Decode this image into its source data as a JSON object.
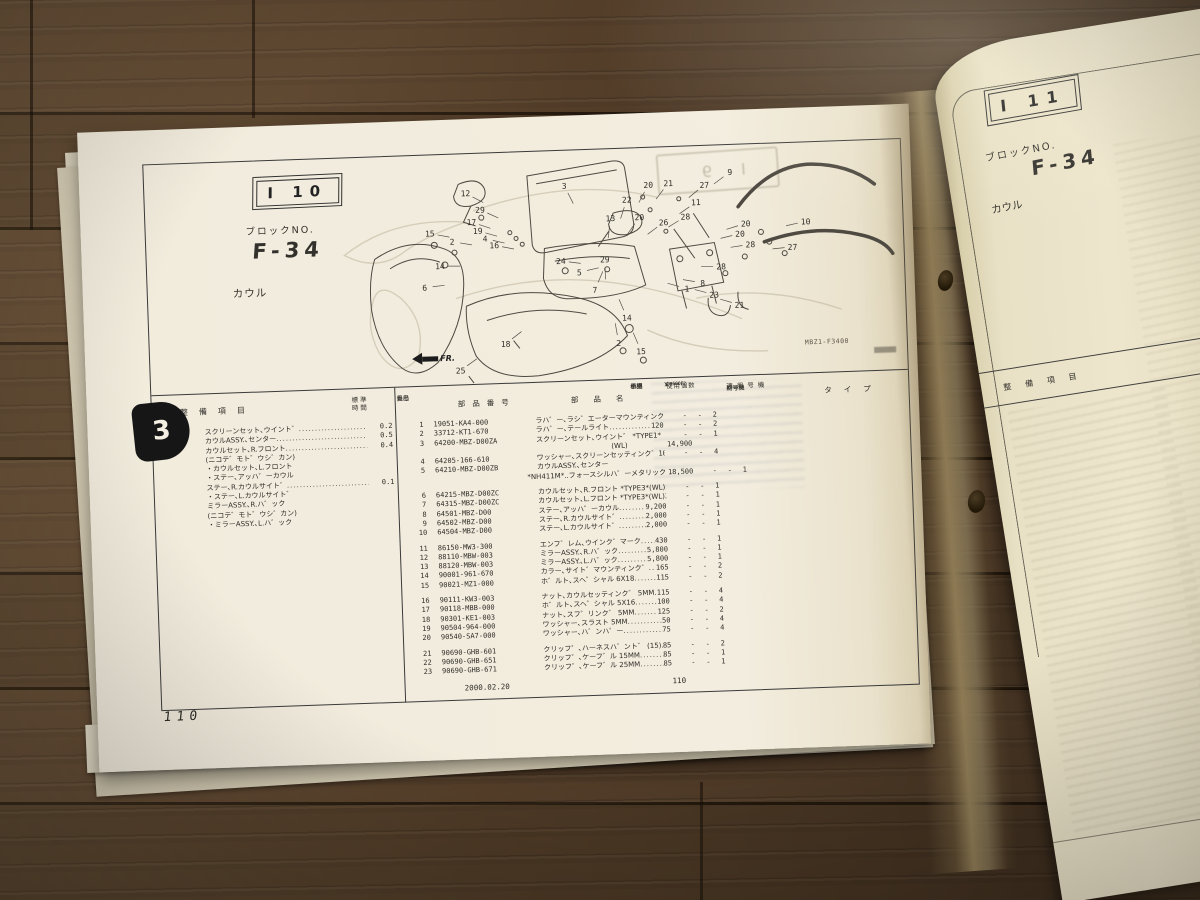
{
  "colors": {
    "paper": "#f2ecdd",
    "paper_right": "#e9e1c6",
    "ink": "#33312c",
    "wood": "#56402a",
    "thumb_tab_bg": "#161616"
  },
  "left_page": {
    "thumb_tab": "3",
    "tab": "I 10",
    "block_label": "ブロックNO.",
    "block_no": "F-34",
    "category": "カウル",
    "ghost_tab": "I 9",
    "fr_label": "FR.",
    "diagram_code": "MBZ1-F3400",
    "page_number": "110",
    "callouts": [
      {
        "n": "12",
        "x": 153,
        "y": 40
      },
      {
        "n": "29",
        "x": 167,
        "y": 57
      },
      {
        "n": "17",
        "x": 158,
        "y": 69
      },
      {
        "n": "19",
        "x": 164,
        "y": 78
      },
      {
        "n": "4",
        "x": 171,
        "y": 86
      },
      {
        "n": "16",
        "x": 180,
        "y": 93
      },
      {
        "n": "3",
        "x": 252,
        "y": 36
      },
      {
        "n": "13",
        "x": 297,
        "y": 70
      },
      {
        "n": "22",
        "x": 314,
        "y": 52
      },
      {
        "n": "20",
        "x": 336,
        "y": 38
      },
      {
        "n": "20",
        "x": 326,
        "y": 70
      },
      {
        "n": "21",
        "x": 356,
        "y": 37
      },
      {
        "n": "27",
        "x": 392,
        "y": 40
      },
      {
        "n": "9",
        "x": 418,
        "y": 28
      },
      {
        "n": "11",
        "x": 383,
        "y": 57
      },
      {
        "n": "26",
        "x": 350,
        "y": 76
      },
      {
        "n": "28",
        "x": 372,
        "y": 71
      },
      {
        "n": "20",
        "x": 432,
        "y": 80
      },
      {
        "n": "20",
        "x": 426,
        "y": 90
      },
      {
        "n": "10",
        "x": 492,
        "y": 80
      },
      {
        "n": "27",
        "x": 478,
        "y": 105
      },
      {
        "n": "28",
        "x": 436,
        "y": 101
      },
      {
        "n": "28",
        "x": 406,
        "y": 122
      },
      {
        "n": "23",
        "x": 398,
        "y": 150
      },
      {
        "n": "21",
        "x": 423,
        "y": 161
      },
      {
        "n": "1",
        "x": 371,
        "y": 143
      },
      {
        "n": "8",
        "x": 387,
        "y": 138
      },
      {
        "n": "15",
        "x": 116,
        "y": 79
      },
      {
        "n": "2",
        "x": 138,
        "y": 88
      },
      {
        "n": "14",
        "x": 125,
        "y": 112
      },
      {
        "n": "24",
        "x": 246,
        "y": 111
      },
      {
        "n": "29",
        "x": 290,
        "y": 111
      },
      {
        "n": "5",
        "x": 264,
        "y": 123
      },
      {
        "n": "6",
        "x": 109,
        "y": 133
      },
      {
        "n": "7",
        "x": 279,
        "y": 141
      },
      {
        "n": "18",
        "x": 188,
        "y": 192
      },
      {
        "n": "25",
        "x": 142,
        "y": 217
      },
      {
        "n": "14",
        "x": 310,
        "y": 170
      },
      {
        "n": "2",
        "x": 301,
        "y": 195
      },
      {
        "n": "15",
        "x": 323,
        "y": 204
      }
    ],
    "maintenance": {
      "header_item": "整備項目",
      "header_time1": "標準",
      "header_time2": "時間",
      "rows": [
        {
          "name": "スクリーンセット､ウイント゛",
          "time": "0.2"
        },
        {
          "name": "カウルASSY.､センター",
          "time": "0.5"
        },
        {
          "name": "カウルセット､R.フロント",
          "time": "0.4"
        },
        {
          "name": "(ニコテ゛モト゛ウシ゛カン)",
          "time": ""
        },
        {
          "name": "・カウルセット､L.フロント",
          "time": ""
        },
        {
          "name": "・ステー､アッハ゜ーカウル",
          "time": ""
        },
        {
          "name": "ステー､R.カウルサイト゛",
          "time": "0.1"
        },
        {
          "name": "・ステー､L.カウルサイト゛",
          "time": ""
        },
        {
          "name": "ミラーASSY.､R.ハ゛ック",
          "time": ""
        },
        {
          "name": "(ニコテ゛モト゛ウシ゛カン)",
          "time": ""
        },
        {
          "name": "・ミラーASSY.､L.ハ゛ック",
          "time": ""
        }
      ]
    },
    "parts": {
      "headers": {
        "ref1": "見出",
        "ref2": "番号",
        "part_no": "部品番号",
        "name": "部品名",
        "price1": "希望",
        "price2": "小売",
        "price3": "価格",
        "qty": "使用個数",
        "qty_m1": "CB600F",
        "qty_m2": "CB600F2",
        "qty_k1": "X",
        "qty_k2": "Y",
        "qty_k3": "Y",
        "applied": "適用号機",
        "applied_first": "初号機",
        "applied_last": "終号機",
        "type": "タイプ"
      },
      "rows": [
        {
          "ref": "1",
          "part": "19051-KA4-000",
          "name": "ラハ゛ー､ラシ゛エーターマウンティンク゛",
          "dots": true,
          "price": "140",
          "q": "2"
        },
        {
          "ref": "2",
          "part": "33712-KT1-670",
          "name": "ラハ゛ー､テールライト",
          "dots": true,
          "price": "120",
          "q": "2"
        },
        {
          "ref": "3",
          "part": "64200-MBZ-D00ZA",
          "name": "スクリーンセット､ウイント゛ *TYPE1*",
          "q": "1",
          "line2": {
            "pos": "a",
            "text": "(WL)",
            "price": "14,900"
          }
        },
        {
          "ref": "4",
          "part": "64205-166-610",
          "name": "ワッシャー､スクリーンセッティンク゛",
          "dots": true,
          "price": "100",
          "q": "4"
        },
        {
          "ref": "5",
          "part": "64210-MBZ-D00ZB",
          "name": "カウルASSY.､センター",
          "line2": {
            "pos": "b",
            "text": "*NH411M*..フォースシルハ゛ーメタリック",
            "price": "18,500",
            "q": "1"
          }
        },
        {
          "ref": "6",
          "part": "64215-MBZ-D00ZC",
          "name": "カウルセット､R.フロント *TYPE3*(WL)",
          "price": "23,400",
          "q": "1",
          "gap": true
        },
        {
          "ref": "7",
          "part": "64315-MBZ-D00ZC",
          "name": "カウルセット､L.フロント *TYPE3*(WL)",
          "price": "23,400",
          "q": "1"
        },
        {
          "ref": "8",
          "part": "64501-MBZ-D00",
          "name": "ステー､アッハ゜ーカウル",
          "dots": true,
          "price": "9,200",
          "q": "1"
        },
        {
          "ref": "9",
          "part": "64502-MBZ-D00",
          "name": "ステー､R.カウルサイト゛",
          "dots": true,
          "price": "2,000",
          "q": "1"
        },
        {
          "ref": "10",
          "part": "64504-MBZ-D00",
          "name": "ステー､L.カウルサイト゛",
          "dots": true,
          "price": "2,000",
          "q": "1"
        },
        {
          "ref": "11",
          "part": "86150-MW3-300",
          "name": "エンフ゛レム､ウインク゛マーク",
          "dots": true,
          "price": "430",
          "q": "1",
          "gap": true
        },
        {
          "ref": "12",
          "part": "88110-MBW-003",
          "name": "ミラーASSY.､R.ハ゛ック",
          "dots": true,
          "price": "5,800",
          "q": "1"
        },
        {
          "ref": "13",
          "part": "88120-MBW-003",
          "name": "ミラーASSY.､L.ハ゛ック",
          "dots": true,
          "price": "5,800",
          "q": "1"
        },
        {
          "ref": "14",
          "part": "90001-961-670",
          "name": "カラー､サイト゛マウンティンク゛",
          "dots": true,
          "price": "165",
          "q": "2"
        },
        {
          "ref": "15",
          "part": "90021-MZ1-000",
          "name": "ホ゛ルト､スヘ゜シャル 6X18",
          "dots": true,
          "price": "115",
          "q": "2"
        },
        {
          "ref": "16",
          "part": "90111-KW3-003",
          "name": "ナット､カウルセッティンク゛ 5MM",
          "dots": true,
          "price": "115",
          "q": "4",
          "gap": true
        },
        {
          "ref": "17",
          "part": "90118-MBB-000",
          "name": "ホ゛ルト､スヘ゜シャル 5X16",
          "dots": true,
          "price": "100",
          "q": "4"
        },
        {
          "ref": "18",
          "part": "90301-KE1-003",
          "name": "ナット､スフ゜リンク゛ 5MM",
          "dots": true,
          "price": "125",
          "q": "2"
        },
        {
          "ref": "19",
          "part": "90504-964-000",
          "name": "ワッシャー､スラスト 5MM",
          "dots": true,
          "price": "50",
          "q": "4"
        },
        {
          "ref": "20",
          "part": "90540-SA7-000",
          "name": "ワッシャー､ハ゛ンハ゜ー",
          "dots": true,
          "price": "75",
          "q": "4"
        },
        {
          "ref": "21",
          "part": "90690-GHB-601",
          "name": "クリッフ゜､ハーネスハ゛ント゛ (15)",
          "dots": true,
          "price": "85",
          "q": "2",
          "gap": true
        },
        {
          "ref": "22",
          "part": "90690-GHB-651",
          "name": "クリッフ゜､ケーフ゛ル 15MM",
          "dots": true,
          "price": "85",
          "q": "1"
        },
        {
          "ref": "23",
          "part": "90690-GHB-671",
          "name": "クリッフ゜､ケーフ゛ル 25MM",
          "dots": true,
          "price": "85",
          "q": "1"
        }
      ],
      "footer_date": "2000.02.20",
      "footer_page": "110"
    }
  },
  "right_page": {
    "tab": "I 11",
    "block_label": "ブロックNO.",
    "block_no": "F-34",
    "category": "カウル",
    "header_item": "整備項目",
    "header_time1": "標準",
    "header_time2": "時間"
  }
}
